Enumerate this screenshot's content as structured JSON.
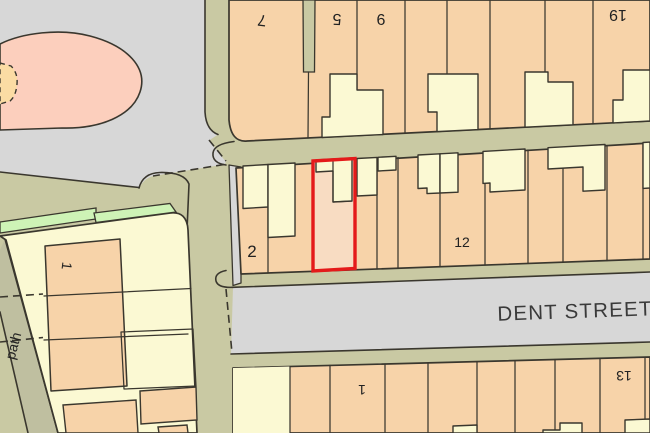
{
  "labels": {
    "street": "DENT STREET",
    "path": "path",
    "plot7": "7",
    "plot5": "5",
    "plot6": "6",
    "plot19": "19",
    "plot2": "2",
    "plot12": "12",
    "plot1_south": "1",
    "plot13": "13",
    "plot1_west": "1"
  },
  "colors": {
    "road": "#d7d7d7",
    "verge": "#c9c9a3",
    "corridor": "#bfbfa0",
    "parcel": "#f7d3a9",
    "parcel_light": "#f8dcc2",
    "pink": "#fccfbd",
    "cream": "#fbf9d3",
    "green": "#cef3b6",
    "patch": "#fbdca4",
    "outline": "#3a372e",
    "highlight": "#e41a1a",
    "text": "#222222",
    "street_text": "#3a3a3a"
  }
}
